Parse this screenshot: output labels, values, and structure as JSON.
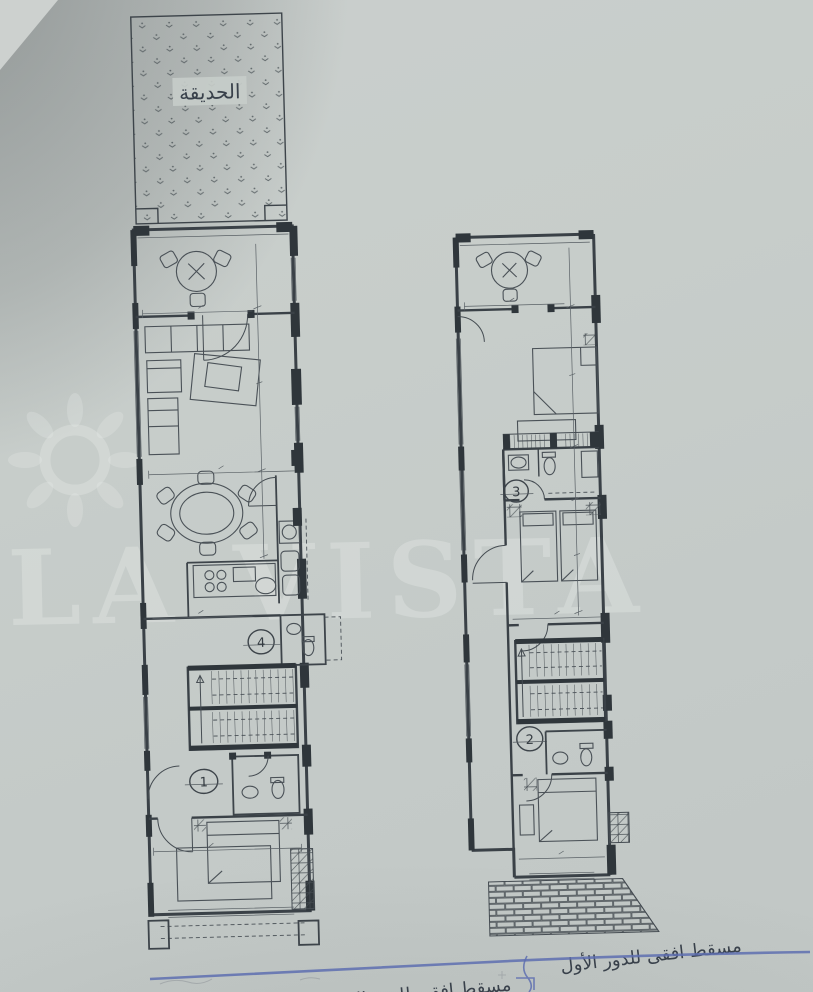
{
  "photo": {
    "paper_color": "#c6ccc9",
    "ink_color": "#3a4147",
    "pen_color": "#5e6fb0",
    "description": "scanned architectural floor plan drawing, two plans side by side"
  },
  "watermark": {
    "text": "LA VISTA",
    "logo": "sun-icon"
  },
  "garden": {
    "label": "الحديقة"
  },
  "ground_plan": {
    "caption": "مسقط افقي للدور الارضي",
    "marker_stair_hall": "4",
    "marker_entry": "1"
  },
  "first_plan": {
    "caption": "مسقط افقى للدور الأول",
    "marker_bath": "3",
    "marker_hall": "2"
  }
}
